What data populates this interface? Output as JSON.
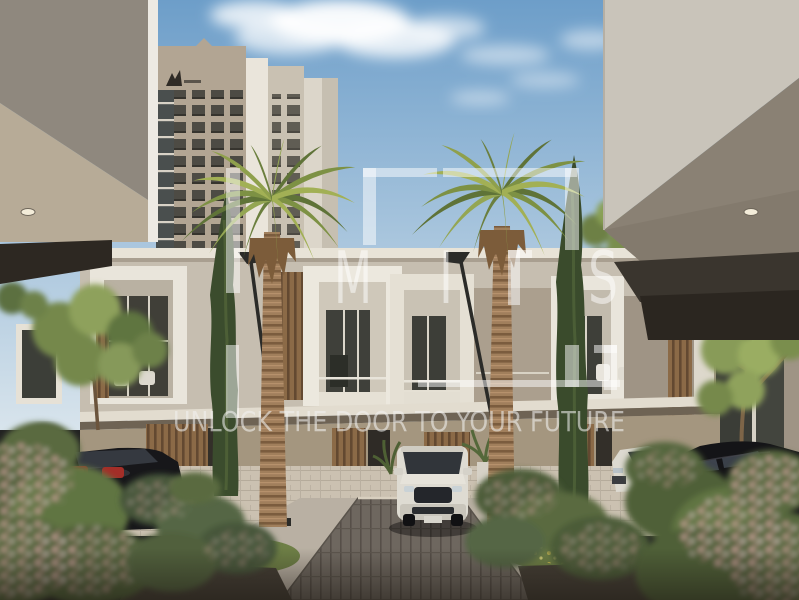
{
  "meta": {
    "description": "Daylight architectural rendering: modern two-storey townhouses with framed balconies seen down a paved driveway between two white building canopies, two tall palm trees, cypresses, parked cars and a beige high-rise tower in the background",
    "width": 799,
    "height": 600
  },
  "watermark": {
    "tagline": "UNLOCK THE DOOR TO YOUR FUTURE",
    "monogram_letters": [
      "M",
      "I",
      "S"
    ],
    "style": "semi-transparent white corner-bracket monogram",
    "color": "#ffffff",
    "opacity": 0.5
  },
  "palette": {
    "sky_top": "#6d9ec9",
    "sky_horizon": "#d8e4ec",
    "tower_face": "#b2a593",
    "townhouse_white": "#ece8de",
    "wood_slats": "#8b6a47",
    "palm_green": "#7d9144",
    "cypress_green": "#3b4c2d",
    "road_pavers": "#6e675f",
    "flower_pink": "#e6b6b0",
    "fascia_dark": "#2d2822"
  }
}
